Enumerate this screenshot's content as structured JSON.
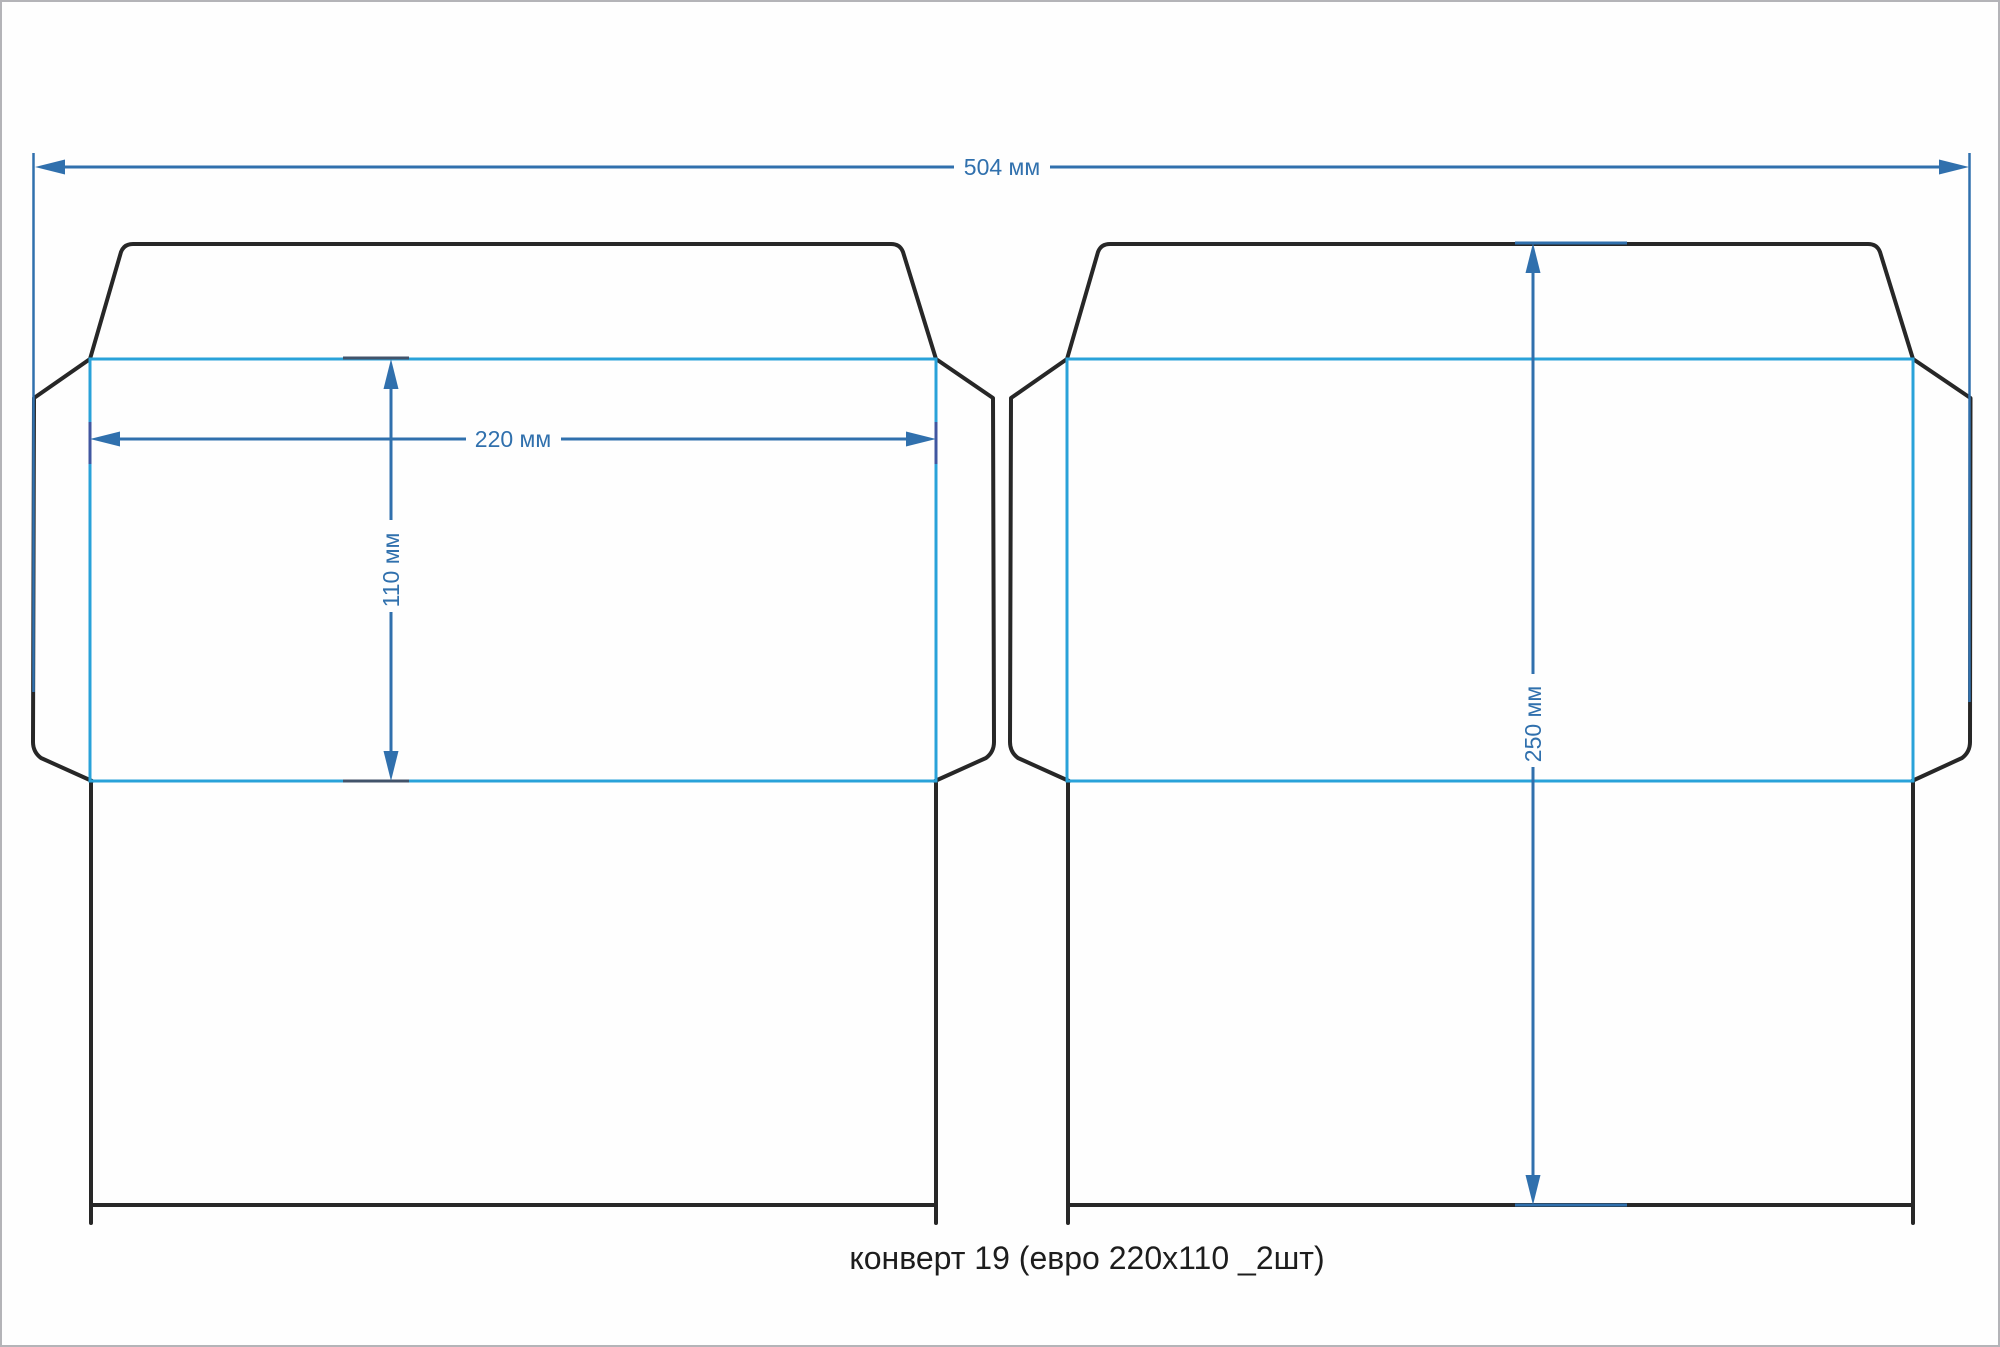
{
  "caption": "конверт 19 (евро 220х110 _2шт)",
  "product": {
    "name": "конверт 19",
    "format": "евро 220х110",
    "quantity_per_sheet": 2
  },
  "dimensions": {
    "total_width": {
      "value": 504,
      "unit": "мм",
      "label": "504 мм"
    },
    "face_width": {
      "value": 220,
      "unit": "мм",
      "label": "220 мм"
    },
    "face_height": {
      "value": 110,
      "unit": "мм",
      "label": "110 мм"
    },
    "blank_height": {
      "value": 250,
      "unit": "мм",
      "label": "250 мм"
    }
  },
  "colors": {
    "dimension_blue": "#3070ad",
    "fold_line_cyan": "#29a2d9",
    "cut_line_black": "#272727",
    "caption_text": "#1d1d1d",
    "background": "#fefefe"
  }
}
